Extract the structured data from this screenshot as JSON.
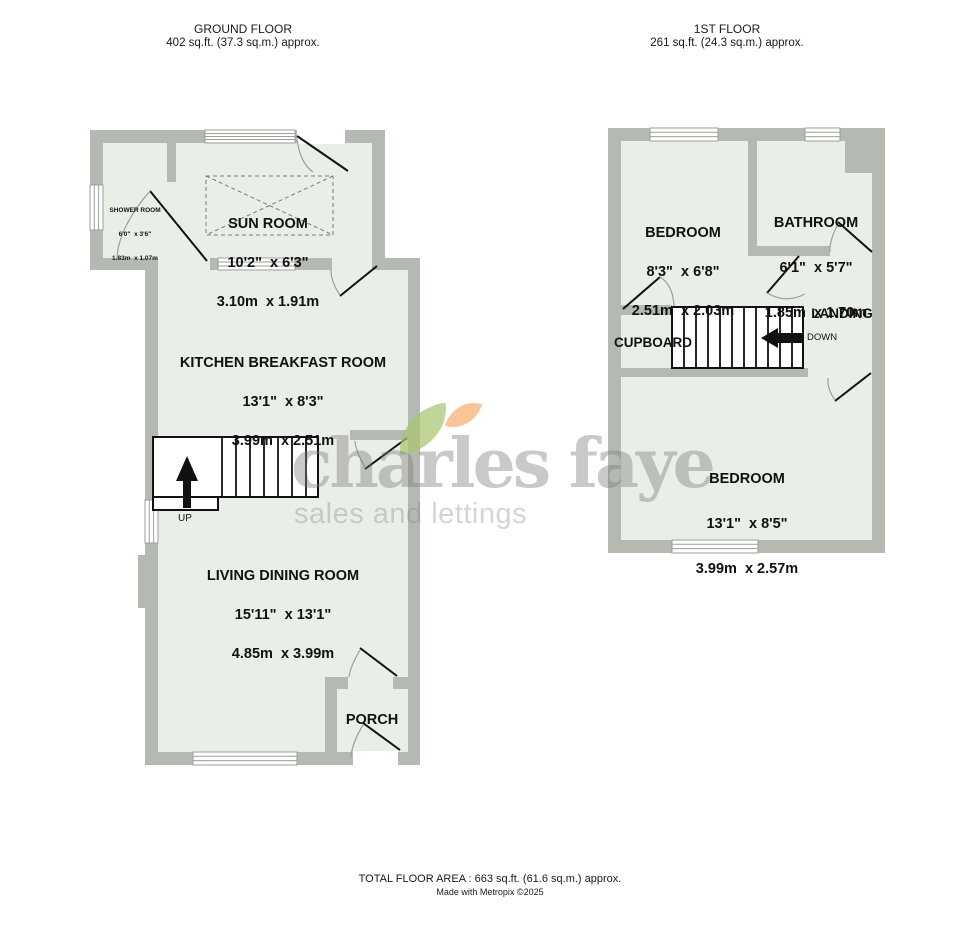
{
  "headers": {
    "ground": {
      "title": "GROUND FLOOR",
      "area": "402 sq.ft. (37.3 sq.m.) approx."
    },
    "first": {
      "title": "1ST FLOOR",
      "area": "261 sq.ft. (24.3 sq.m.) approx."
    }
  },
  "ground_floor": {
    "shower_room": {
      "name": "SHOWER ROOM",
      "imperial": "6'0\"  x 3'6\"",
      "metric": "1.83m  x 1.07m"
    },
    "sun_room": {
      "name": "SUN ROOM",
      "imperial": "10'2\"  x 6'3\"",
      "metric": "3.10m  x 1.91m"
    },
    "kitchen": {
      "name": "KITCHEN BREAKFAST ROOM",
      "imperial": "13'1\"  x 8'3\"",
      "metric": "3.99m  x 2.51m"
    },
    "living": {
      "name": "LIVING DINING ROOM",
      "imperial": "15'11\"  x 13'1\"",
      "metric": "4.85m  x 3.99m"
    },
    "porch": {
      "name": "PORCH"
    },
    "stairs_label": "UP"
  },
  "first_floor": {
    "bedroom1": {
      "name": "BEDROOM",
      "imperial": "8'3\"  x 6'8\"",
      "metric": "2.51m  x 2.03m"
    },
    "bathroom": {
      "name": "BATHROOM",
      "imperial": "6'1\"  x 5'7\"",
      "metric": "1.85m  x 1.70m"
    },
    "bedroom2": {
      "name": "BEDROOM",
      "imperial": "13'1\"  x 8'5\"",
      "metric": "3.99m  x 2.57m"
    },
    "landing_label": "LANDING",
    "cupboard_label": "CUPBOARD",
    "stairs_label": "DOWN"
  },
  "watermark": {
    "brand": "charles faye",
    "tagline": "sales and lettings"
  },
  "footer": {
    "total_area": "TOTAL FLOOR AREA : 663 sq.ft. (61.6 sq.m.) approx.",
    "credit": "Made with Metropix ©2025"
  },
  "colors": {
    "wall": "#b4bab2",
    "room_fill": "#e9eee7",
    "leaf_green": "#a7c570",
    "leaf_orange": "#f5b57a"
  }
}
